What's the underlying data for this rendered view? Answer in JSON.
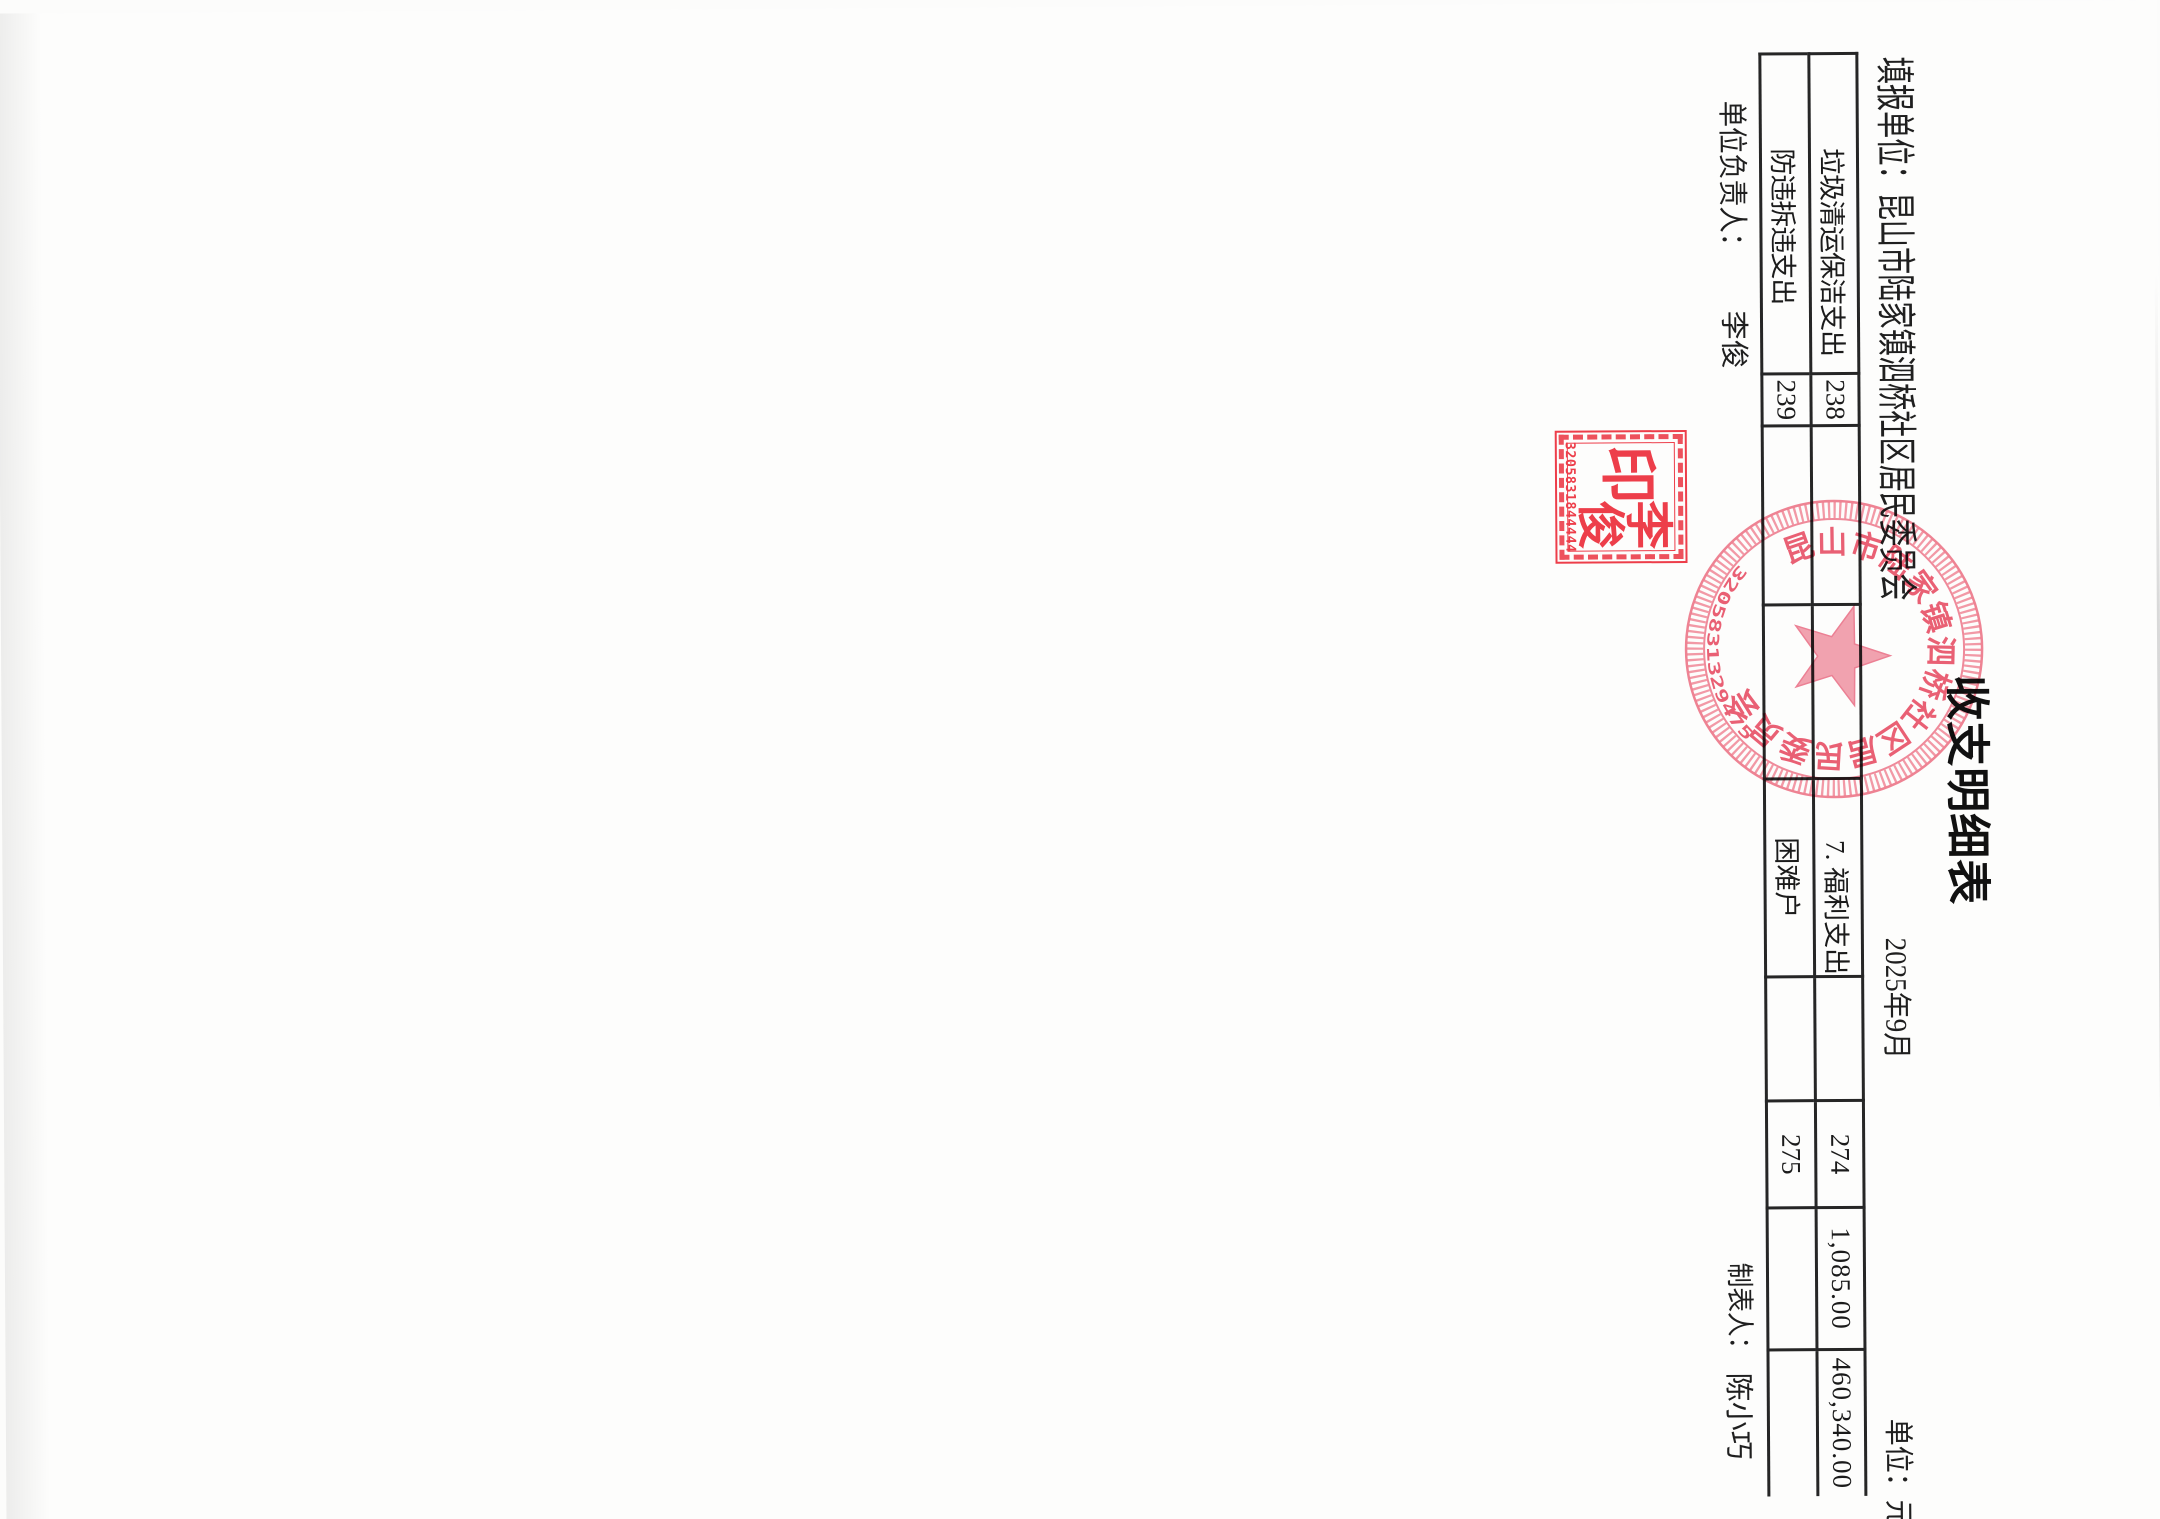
{
  "document": {
    "title": "收支明细表",
    "report_unit_line": "填报单位：昆山市陆家镇泗桥社区居民委员会",
    "period": "2025年9月",
    "unit_note": "单位：元"
  },
  "table": {
    "rows": [
      {
        "item_left": "垃圾清运保洁支出",
        "no_left": "238",
        "amt_left_month": "",
        "amt_left_total": "",
        "item_right": "7. 福利支出",
        "spare": "",
        "no_right": "274",
        "amt_month": "1,085.00",
        "amt_total": "460,340.00"
      },
      {
        "item_left": "防违拆违支出",
        "no_left": "239",
        "amt_left_month": "",
        "amt_left_total": "",
        "item_right": "困难户",
        "spare": "",
        "no_right": "275",
        "amt_month": "",
        "amt_total": ""
      }
    ]
  },
  "footer": {
    "responsible_label": "单位负责人：",
    "responsible_name": "李俊",
    "preparer_label": "制表人：",
    "preparer_name": "陈小巧"
  },
  "stamps": {
    "square_seal": {
      "char_yin": "印",
      "char_li": "李",
      "char_jun": "俊",
      "code": "3205831844444"
    },
    "round_seal": {
      "org": "昆山市陆家镇泗桥社区居民委员会",
      "code": "3205831329475"
    }
  },
  "colors": {
    "seal_red": "#ee2f3d",
    "round_seal_red": "#ea4f68",
    "table_line": "#262626"
  }
}
